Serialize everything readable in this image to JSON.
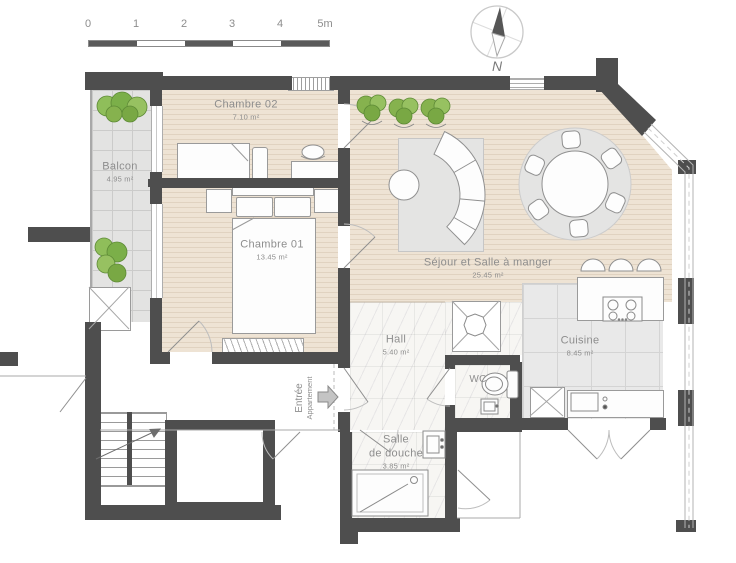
{
  "scale_bar": {
    "ticks": [
      "0",
      "1",
      "2",
      "3",
      "4",
      "5m"
    ]
  },
  "compass": {
    "north_label": "N"
  },
  "rooms": {
    "balcon": {
      "name": "Balcon",
      "area": "4.95 m²"
    },
    "chambre_02": {
      "name": "Chambre 02",
      "area": "7.10 m²"
    },
    "chambre_01": {
      "name": "Chambre 01",
      "area": "13.45 m²"
    },
    "sejour": {
      "name": "Séjour et Salle à manger",
      "area": "25.45 m²"
    },
    "cuisine": {
      "name": "Cuisine",
      "area": "8.45 m²"
    },
    "hall": {
      "name": "Hall",
      "area": "5.40 m²"
    },
    "wc": {
      "name": "WC"
    },
    "salle_de_douche": {
      "name_line1": "Salle",
      "name_line2": "de douche",
      "area": "3.85 m²"
    },
    "entree": {
      "line1": "Entrée",
      "line2": "Appartement"
    }
  },
  "colors": {
    "wall": "#4e4e4e",
    "wood_floor": "#eee3d4",
    "wood_stripe": "#e0d2c0",
    "tile": "#e3e3e2",
    "marble": "#f7f6f3",
    "rug": "#e4e4e3",
    "plant_green": "#8fbe5a",
    "label_text": "#8d8d8d",
    "furniture_outline": "#9a9a9a"
  }
}
